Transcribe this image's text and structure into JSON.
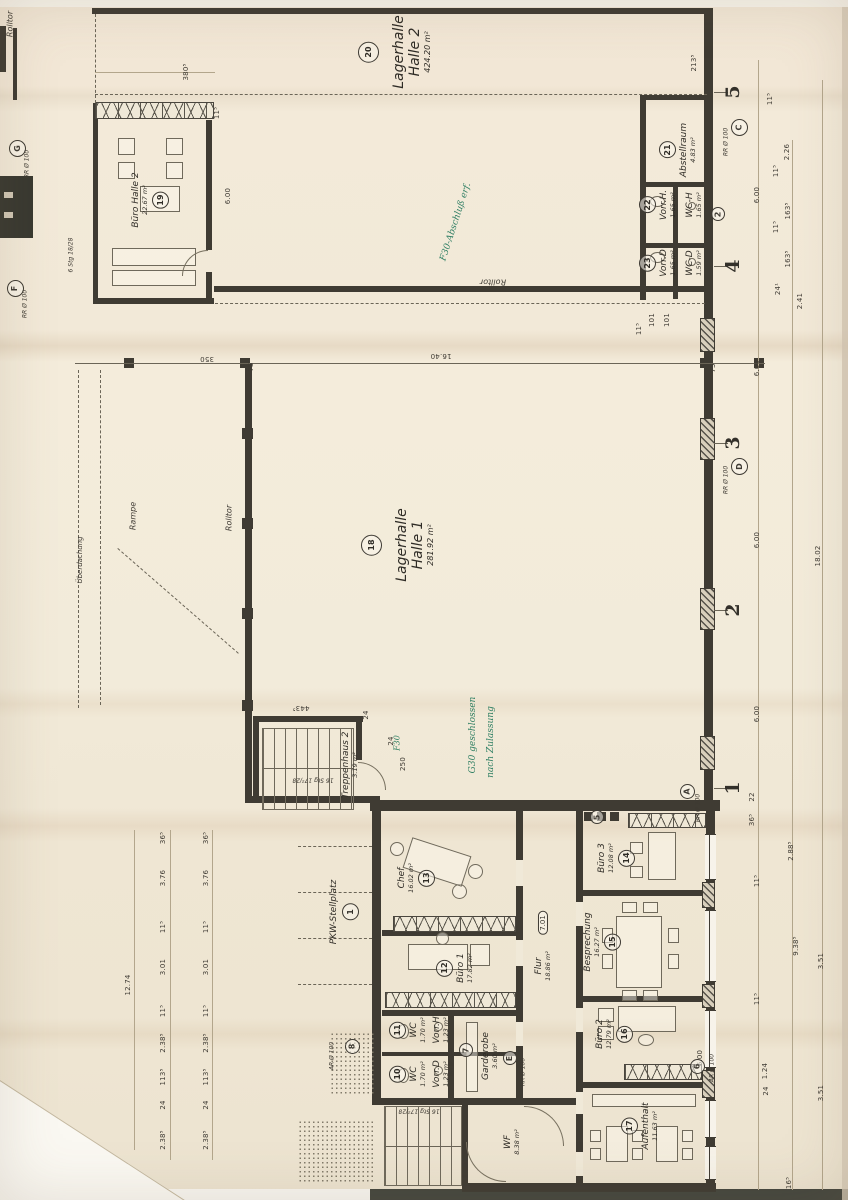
{
  "plan": {
    "colors": {
      "paper": "#efe6d4",
      "ink": "#3f3b33",
      "green_annotation": "#2f7f63"
    },
    "rooms": [
      {
        "num": "20",
        "name": "Lagerhalle",
        "sub": "Halle 2",
        "area": "424.20 m²",
        "x": 395,
        "y": 52,
        "big": 1,
        "cpos": "b"
      },
      {
        "num": "19",
        "name": "Büro Halle 2",
        "area": "22.67 m²",
        "x": 150,
        "y": 200,
        "cpos": "a"
      },
      {
        "num": "21",
        "name": "Abstellraum",
        "area": "4.83 m²",
        "x": 678,
        "y": 150,
        "cpos": "b"
      },
      {
        "num": "22",
        "name": "Vorr.H.",
        "area": "1.65 m²",
        "x": 658,
        "y": 205,
        "cpos": "b"
      },
      {
        "name": "WC-H",
        "area": "1.65 m²",
        "x": 694,
        "y": 205
      },
      {
        "num": "23",
        "name": "Vorr.D",
        "area": "1.65 m²",
        "x": 658,
        "y": 263,
        "cpos": "b"
      },
      {
        "name": "WC-D",
        "area": "1.59 m²",
        "x": 694,
        "y": 263
      },
      {
        "num": "18",
        "name": "Lagerhalle",
        "sub": "Halle 1",
        "area": "281.92 m²",
        "x": 398,
        "y": 545,
        "big": 1,
        "cpos": "b"
      },
      {
        "name": "Treppenhaus 2",
        "area": "3.19 m²",
        "x": 350,
        "y": 765
      },
      {
        "num": "13",
        "name": "Chef",
        "area": "16.02 m²",
        "x": 416,
        "y": 878,
        "cpos": "a"
      },
      {
        "num": "12",
        "name": "Büro 1",
        "area": "17.82 m²",
        "x": 455,
        "y": 968,
        "cpos": "b"
      },
      {
        "num": "11",
        "name": "WC",
        "area": "1.70 m²",
        "x": 408,
        "y": 1030,
        "cpos": "b"
      },
      {
        "name": "Vorr.H",
        "area": "1.23 m²",
        "x": 441,
        "y": 1030
      },
      {
        "num": "10",
        "name": "WC",
        "area": "1.70 m²",
        "x": 408,
        "y": 1074,
        "cpos": "b"
      },
      {
        "name": "Vorr.D",
        "area": "1.23 m²",
        "x": 441,
        "y": 1074
      },
      {
        "name": "Garderobe",
        "area": "3.60 m²",
        "x": 490,
        "y": 1056
      },
      {
        "name": "WF",
        "area": "8.38 m²",
        "x": 512,
        "y": 1142
      },
      {
        "name": "Flur",
        "area": "18.86 m²",
        "x": 543,
        "y": 966
      },
      {
        "num": "14",
        "name": "Büro 3",
        "area": "12.08 m²",
        "x": 616,
        "y": 858,
        "cpos": "a"
      },
      {
        "num": "15",
        "name": "Besprechung",
        "area": "16.27 m²",
        "x": 602,
        "y": 942,
        "cpos": "a"
      },
      {
        "num": "16",
        "name": "Büro 2",
        "area": "12.79 m²",
        "x": 614,
        "y": 1034,
        "cpos": "a"
      },
      {
        "num": "17",
        "name": "Aufenthalt",
        "area": "11.63 m²",
        "x": 640,
        "y": 1126,
        "cpos": "b"
      },
      {
        "num": "1",
        "name": "PKW-Stellplatz",
        "x": 344,
        "y": 912,
        "cpos": "a"
      }
    ],
    "grid_numbers": [
      {
        "t": "5",
        "x": 733,
        "y": 92
      },
      {
        "t": "4",
        "x": 733,
        "y": 266
      },
      {
        "t": "3",
        "x": 733,
        "y": 443
      },
      {
        "t": "2",
        "x": 733,
        "y": 610
      },
      {
        "t": "1",
        "x": 733,
        "y": 788
      }
    ],
    "circles": [
      {
        "t": "8",
        "x": 352,
        "y": 1046,
        "d": 15
      },
      {
        "t": "6",
        "x": 697,
        "y": 1066,
        "d": 15
      },
      {
        "t": "7",
        "x": 466,
        "y": 1050,
        "d": 14
      },
      {
        "t": "5",
        "x": 597,
        "y": 817,
        "d": 14
      },
      {
        "t": "2",
        "x": 718,
        "y": 214,
        "d": 14
      },
      {
        "t": "G",
        "x": 17,
        "y": 148,
        "d": 17
      },
      {
        "t": "F",
        "x": 15,
        "y": 288,
        "d": 17
      },
      {
        "t": "C",
        "x": 739,
        "y": 127,
        "d": 17
      },
      {
        "t": "D",
        "x": 739,
        "y": 466,
        "d": 17
      },
      {
        "t": "A",
        "x": 687,
        "y": 791,
        "d": 15
      },
      {
        "t": "E",
        "x": 510,
        "y": 1058,
        "d": 14
      }
    ],
    "texts": [
      {
        "k": "dim",
        "t": "380⁵",
        "x": 186,
        "y": 72
      },
      {
        "k": "dim",
        "t": "11⁵",
        "x": 217,
        "y": 113
      },
      {
        "k": "dim",
        "t": "6.00",
        "x": 228,
        "y": 196
      },
      {
        "k": "dim",
        "t": "213⁵",
        "x": 694,
        "y": 63
      },
      {
        "k": "dim",
        "t": "11⁵",
        "x": 770,
        "y": 99
      },
      {
        "k": "dim",
        "t": "2.26",
        "x": 787,
        "y": 152
      },
      {
        "k": "dim",
        "t": "11⁵",
        "x": 776,
        "y": 171
      },
      {
        "k": "dim",
        "t": "6.00",
        "x": 757,
        "y": 195
      },
      {
        "k": "dim",
        "t": "163⁵",
        "x": 788,
        "y": 211
      },
      {
        "k": "dim",
        "t": "11⁵",
        "x": 776,
        "y": 227
      },
      {
        "k": "dim",
        "t": "163⁵",
        "x": 788,
        "y": 259
      },
      {
        "k": "dim",
        "t": "24¹",
        "x": 778,
        "y": 289
      },
      {
        "k": "dim",
        "t": "2.41",
        "x": 800,
        "y": 301
      },
      {
        "k": "dim",
        "t": "101",
        "x": 652,
        "y": 320
      },
      {
        "k": "dim",
        "t": "101",
        "x": 667,
        "y": 320
      },
      {
        "k": "dim",
        "t": "11⁵",
        "x": 639,
        "y": 329
      },
      {
        "k": "dim",
        "t": "75",
        "x": 251,
        "y": 367
      },
      {
        "k": "dim",
        "t": "75",
        "x": 713,
        "y": 368
      },
      {
        "k": "dim",
        "t": "350",
        "x": 207,
        "y": 359,
        "r": 180
      },
      {
        "k": "dim",
        "t": "16.40",
        "x": 441,
        "y": 356,
        "r": 180
      },
      {
        "k": "dim",
        "t": "6.00",
        "x": 757,
        "y": 368
      },
      {
        "k": "dim",
        "t": "6.00",
        "x": 757,
        "y": 540
      },
      {
        "k": "dim",
        "t": "18.02",
        "x": 818,
        "y": 556
      },
      {
        "k": "dim",
        "t": "6.00",
        "x": 757,
        "y": 714
      },
      {
        "k": "dim",
        "t": "443⁵",
        "x": 301,
        "y": 708,
        "r": 180
      },
      {
        "k": "dim",
        "t": "24",
        "x": 366,
        "y": 715
      },
      {
        "k": "dim",
        "t": "250",
        "x": 403,
        "y": 764
      },
      {
        "k": "dim",
        "t": "24",
        "x": 391,
        "y": 741
      },
      {
        "k": "dim",
        "t": "22",
        "x": 752,
        "y": 797
      },
      {
        "k": "dim",
        "t": "36⁵",
        "x": 752,
        "y": 820
      },
      {
        "k": "dim",
        "t": "2.88⁵",
        "x": 791,
        "y": 851
      },
      {
        "k": "dim",
        "t": "11⁵",
        "x": 757,
        "y": 881
      },
      {
        "k": "dim",
        "t": "9.38⁵",
        "x": 796,
        "y": 946
      },
      {
        "k": "dim",
        "t": "3.51",
        "x": 821,
        "y": 961
      },
      {
        "k": "dim",
        "t": "11⁵",
        "x": 757,
        "y": 999
      },
      {
        "k": "dim",
        "t": "6.00",
        "x": 700,
        "y": 1058
      },
      {
        "k": "dim",
        "t": "1.24",
        "x": 765,
        "y": 1071
      },
      {
        "k": "dim",
        "t": "24",
        "x": 766,
        "y": 1091
      },
      {
        "k": "dim",
        "t": "3.51",
        "x": 821,
        "y": 1093
      },
      {
        "k": "dim",
        "t": "16⁵",
        "x": 789,
        "y": 1183
      },
      {
        "k": "dim",
        "t": "36⁵",
        "x": 163,
        "y": 838
      },
      {
        "k": "dim",
        "t": "36⁵",
        "x": 206,
        "y": 838
      },
      {
        "k": "dim",
        "t": "3.76",
        "x": 163,
        "y": 878
      },
      {
        "k": "dim",
        "t": "3.76",
        "x": 206,
        "y": 878
      },
      {
        "k": "dim",
        "t": "11⁵",
        "x": 163,
        "y": 927
      },
      {
        "k": "dim",
        "t": "11⁵",
        "x": 206,
        "y": 927
      },
      {
        "k": "dim",
        "t": "3.01",
        "x": 163,
        "y": 967
      },
      {
        "k": "dim",
        "t": "3.01",
        "x": 206,
        "y": 967
      },
      {
        "k": "dim",
        "t": "11⁵",
        "x": 163,
        "y": 1011
      },
      {
        "k": "dim",
        "t": "11⁵",
        "x": 206,
        "y": 1011
      },
      {
        "k": "dim",
        "t": "2.38⁵",
        "x": 163,
        "y": 1043
      },
      {
        "k": "dim",
        "t": "2.38⁵",
        "x": 206,
        "y": 1043
      },
      {
        "k": "dim",
        "t": "113⁵",
        "x": 163,
        "y": 1077
      },
      {
        "k": "dim",
        "t": "113⁵",
        "x": 206,
        "y": 1077
      },
      {
        "k": "dim",
        "t": "24",
        "x": 163,
        "y": 1105
      },
      {
        "k": "dim",
        "t": "24",
        "x": 206,
        "y": 1105
      },
      {
        "k": "dim",
        "t": "2.38⁵",
        "x": 163,
        "y": 1140
      },
      {
        "k": "dim",
        "t": "2.38⁵",
        "x": 206,
        "y": 1140
      },
      {
        "k": "dim",
        "t": "12.74",
        "x": 128,
        "y": 985
      },
      {
        "k": "lab",
        "t": "Rolltor",
        "x": 493,
        "y": 282,
        "r": 180
      },
      {
        "k": "lab",
        "t": "Rolltor",
        "x": 229,
        "y": 518
      },
      {
        "k": "lab",
        "t": "Rolltor",
        "x": 10,
        "y": 24
      },
      {
        "k": "lab",
        "t": "Rampe",
        "x": 133,
        "y": 516
      },
      {
        "k": "lab",
        "t": "Überdachung",
        "x": 80,
        "y": 560,
        "s": 7
      },
      {
        "k": "lab",
        "t": "16 Stg 17²/28",
        "x": 313,
        "y": 779,
        "r": 180,
        "s": 6
      },
      {
        "k": "lab",
        "t": "16 Stg 17²/28",
        "x": 419,
        "y": 1110,
        "r": 180,
        "s": 6
      },
      {
        "k": "lab",
        "t": "6 Stg 18/28",
        "x": 72,
        "y": 255,
        "s": 6
      },
      {
        "k": "lab",
        "t": "AR Ø 100",
        "x": 333,
        "y": 1056,
        "s": 6
      },
      {
        "k": "lab",
        "t": "AR Ø 100",
        "x": 713,
        "y": 1068,
        "s": 6
      },
      {
        "k": "lab",
        "t": "BR Ø 100",
        "x": 452,
        "y": 1062,
        "s": 6
      },
      {
        "k": "lab",
        "t": "RR Ø 100",
        "x": 524,
        "y": 1072,
        "s": 6
      },
      {
        "k": "lab",
        "t": "RR Ø 100",
        "x": 727,
        "y": 142,
        "s": 6
      },
      {
        "k": "lab",
        "t": "RR Ø 100",
        "x": 727,
        "y": 480,
        "s": 6
      },
      {
        "k": "lab",
        "t": "RR Ø 100",
        "x": 28,
        "y": 164,
        "s": 6
      },
      {
        "k": "lab",
        "t": "RR Ø 100",
        "x": 26,
        "y": 304,
        "s": 6
      },
      {
        "k": "lab",
        "t": "RR Ø 100",
        "x": 699,
        "y": 808,
        "s": 6
      },
      {
        "k": "green",
        "t": "F30-Abschluß erf.",
        "x": 456,
        "y": 222,
        "r": -72
      },
      {
        "k": "green",
        "t": "G30 geschlossen",
        "x": 473,
        "y": 735
      },
      {
        "k": "green",
        "t": "nach Zulassung",
        "x": 491,
        "y": 742
      },
      {
        "k": "green",
        "t": "F30",
        "x": 397,
        "y": 743,
        "s": 8
      },
      {
        "k": "badge",
        "t": "7.01",
        "x": 543,
        "y": 923
      }
    ]
  }
}
